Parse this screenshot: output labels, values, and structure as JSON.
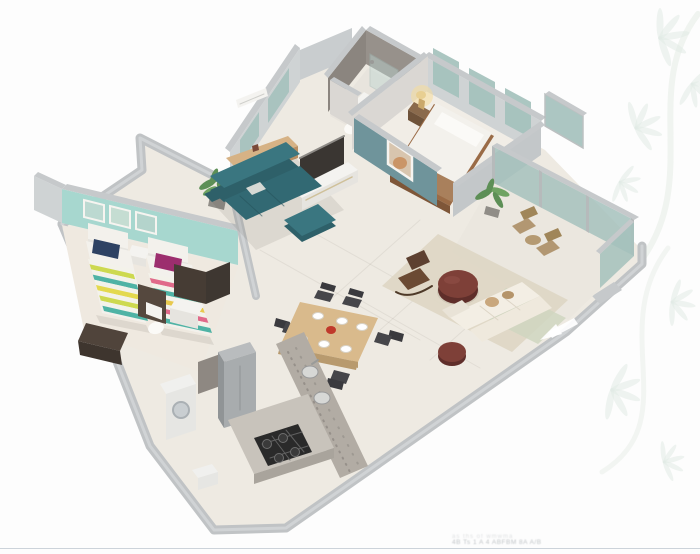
{
  "scene": {
    "type": "isometric-3d-floor-plan",
    "rooms": [
      "master-bedroom",
      "master-bathroom",
      "kids-bedroom",
      "common-bathroom",
      "study-nook",
      "living-room",
      "dining-area",
      "kitchen",
      "utility-area",
      "balcony",
      "family-seating"
    ]
  },
  "watermark": {
    "line1": "as ths of wmwma",
    "line2": "4B Ts 1 A    4 ABFBM 8A A/B"
  },
  "decor": {
    "motif": "leaf-sprigs"
  },
  "palette": {
    "leaf": "#e2ebe5",
    "stem": "#e9efe9",
    "strip": "#dde2e7",
    "wallTop": "#c6c9cb",
    "wallFaceLight": "#cfd3d4",
    "wallFaceLighter": "#dad7d3",
    "band": "#c0c3c5",
    "bandHi": "#d0d3d5",
    "wallSE": "#c3c7c9",
    "bathTaupe": "#97918b",
    "bathTaupeDark": "#8b857f",
    "kitchTaupe": "#8e8882",
    "tealWall": "#a7d7cf",
    "glass": "#a4c1bc",
    "glassLight": "#bcd5d1",
    "slate": "#6f949b",
    "floorMain": "#eeeae2",
    "floorMaster": "#f1ede6",
    "floorBath": "#e8e4dd",
    "floorKids": "#efe9e0",
    "floorBalcony": "#ebe7df",
    "white": "#f4f3f0",
    "whiteDim": "#e6e4df",
    "bedWhite": "#f3f1ec",
    "pillowWhite": "#fbfaf7",
    "navy": "#2e4263",
    "magenta": "#9c2e6e",
    "stripeBase": "#f3f2ea",
    "stripeGreen": "#cdd94f",
    "stripeTealc": "#4fb3a5",
    "stripeYellow": "#e3d94e",
    "stripePink": "#e06a8a",
    "stripeGold": "#e8c94e",
    "sofaTeal": "#2e6069",
    "sofaTealHi": "#3a7680",
    "sofaTealSeat": "#326973",
    "woodDesk": "#d6b285",
    "woodDeskFront": "#b98f63",
    "woodBedFrame": "#9a6b46",
    "woodBedFront": "#7e5638",
    "woodThrow": "#a9805c",
    "woodTable": "#d9ba8c",
    "woodTableEdge": "#b89a6e",
    "woodChairBal": "#b29772",
    "woodChairBalDark": "#a08659",
    "woodRock": "#6b4a33",
    "woodRockDark": "#5d4030",
    "woodRed": "#7e4038",
    "woodRedDark": "#5f2e2a",
    "cream": "#f3eee4",
    "creamDim": "#efe9dd",
    "creamDark": "#e9e3d7",
    "tan": "#c9a77d",
    "rugBeige": "#ded7c5",
    "rugSage": "#cfd6bf",
    "granite": "#b2aca4",
    "graniteDark": "#a9a49c",
    "counter": "#c8c3bb",
    "hob": "#2a2a2a",
    "steel": "#d7d8d6",
    "fridge": "#b9bcbe",
    "fridgeFront": "#a8acae",
    "fridgeSide": "#909496",
    "appliance": "#f0f0ee",
    "applianceFront": "#e6e6e3",
    "darkPanel": "#3a3632",
    "darkWood": "#50443b",
    "darkWoodFront": "#3e352e",
    "darkBathA": "#463c34",
    "darkBathB": "#55483e",
    "darkBathC": "#3e3731",
    "plantGreen": "#5d8f56",
    "plantGreenHi": "#6fa362",
    "pot": "#908d87",
    "lampGlow": "#f5dd9b",
    "lampShade": "#e8cf92",
    "lampBody": "#caa86a",
    "chairDark": "#46464a",
    "chairDarkBack": "#3a3a3e",
    "plate": "#ffffff",
    "plateEdge": "#d8d2c6",
    "centerpiece": "#c0392b",
    "artFrame": "#f6f4f0",
    "artFill": "#d8c5ae",
    "artBlob": "#c98f5f",
    "shadow": "rgba(70,60,45,0.10)"
  }
}
